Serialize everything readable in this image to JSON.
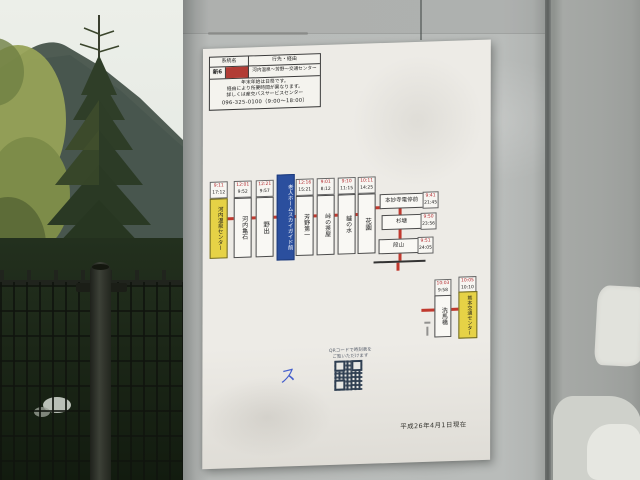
{
  "scene": {
    "colors": {
      "sky": "#e9ebe7",
      "mountain": "#4f5c53",
      "conifer": "#2f3e28",
      "foliage_yellow_green": "#97a257",
      "pole_concrete": "#b8bbb9",
      "right_wall": "#a2a5a2",
      "poster_paper": "#edebe6",
      "route_line_red": "#c0392e",
      "terminal_yellow": "#e6d246",
      "note_blue": "#2b4f9e",
      "header_swatch_red": "#b23c35"
    }
  },
  "poster": {
    "header": {
      "col_route": "系統名",
      "col_destination": "行先・経由",
      "route_no": "新6",
      "destination": "河内温泉～芳野～交通センター",
      "notice_line1": "年末年始は日祭です。",
      "notice_line2": "経由により所要時間が異なります。",
      "notice_line3": "詳しくは産交バスサービスセンター",
      "notice_line4": "096-325-0100（9:00～18:00）"
    },
    "route_map": {
      "chain": [
        {
          "name": "河内温泉センター",
          "time_top": "9:11",
          "time_bottom": "17:12"
        },
        {
          "name": "河内亀石",
          "time_top": "12:01",
          "time_bottom": "9:52"
        },
        {
          "name": "野出",
          "time_top": "12:21",
          "time_bottom": "9:57"
        },
        {
          "name": "老人ホームスカイガイド前"
        },
        {
          "name": "芳野第一",
          "time_top": "12:16",
          "time_bottom": "15:21"
        },
        {
          "name": "峠の茶屋",
          "time_top": "9:01",
          "time_bottom": "8:12"
        },
        {
          "name": "鑪の水",
          "time_top": "9:10",
          "time_bottom": "11:15"
        },
        {
          "name": "花園",
          "time_top": "10:11",
          "time_bottom": "14:25"
        }
      ],
      "branch": [
        {
          "name": "本妙寺電停前",
          "time_top": "9:41",
          "time_bottom": "21:45"
        },
        {
          "name": "杉塘",
          "time_top": "9:50",
          "time_bottom": "23:56"
        },
        {
          "name": "段山",
          "time_top": "9:51",
          "time_bottom": "24:05"
        }
      ],
      "terminal": [
        {
          "name": "洗馬橋",
          "time_top": "10:03",
          "time_bottom": "9:58"
        },
        {
          "name": "熊本交通センター",
          "time_top": "10:05",
          "time_bottom": "10:10"
        }
      ]
    },
    "qr": {
      "caption_line1": "QRコードで時刻表を",
      "caption_line2": "ご覧いただけます"
    },
    "hand_mark": "ス",
    "as_of": "平成26年4月1日現在"
  }
}
